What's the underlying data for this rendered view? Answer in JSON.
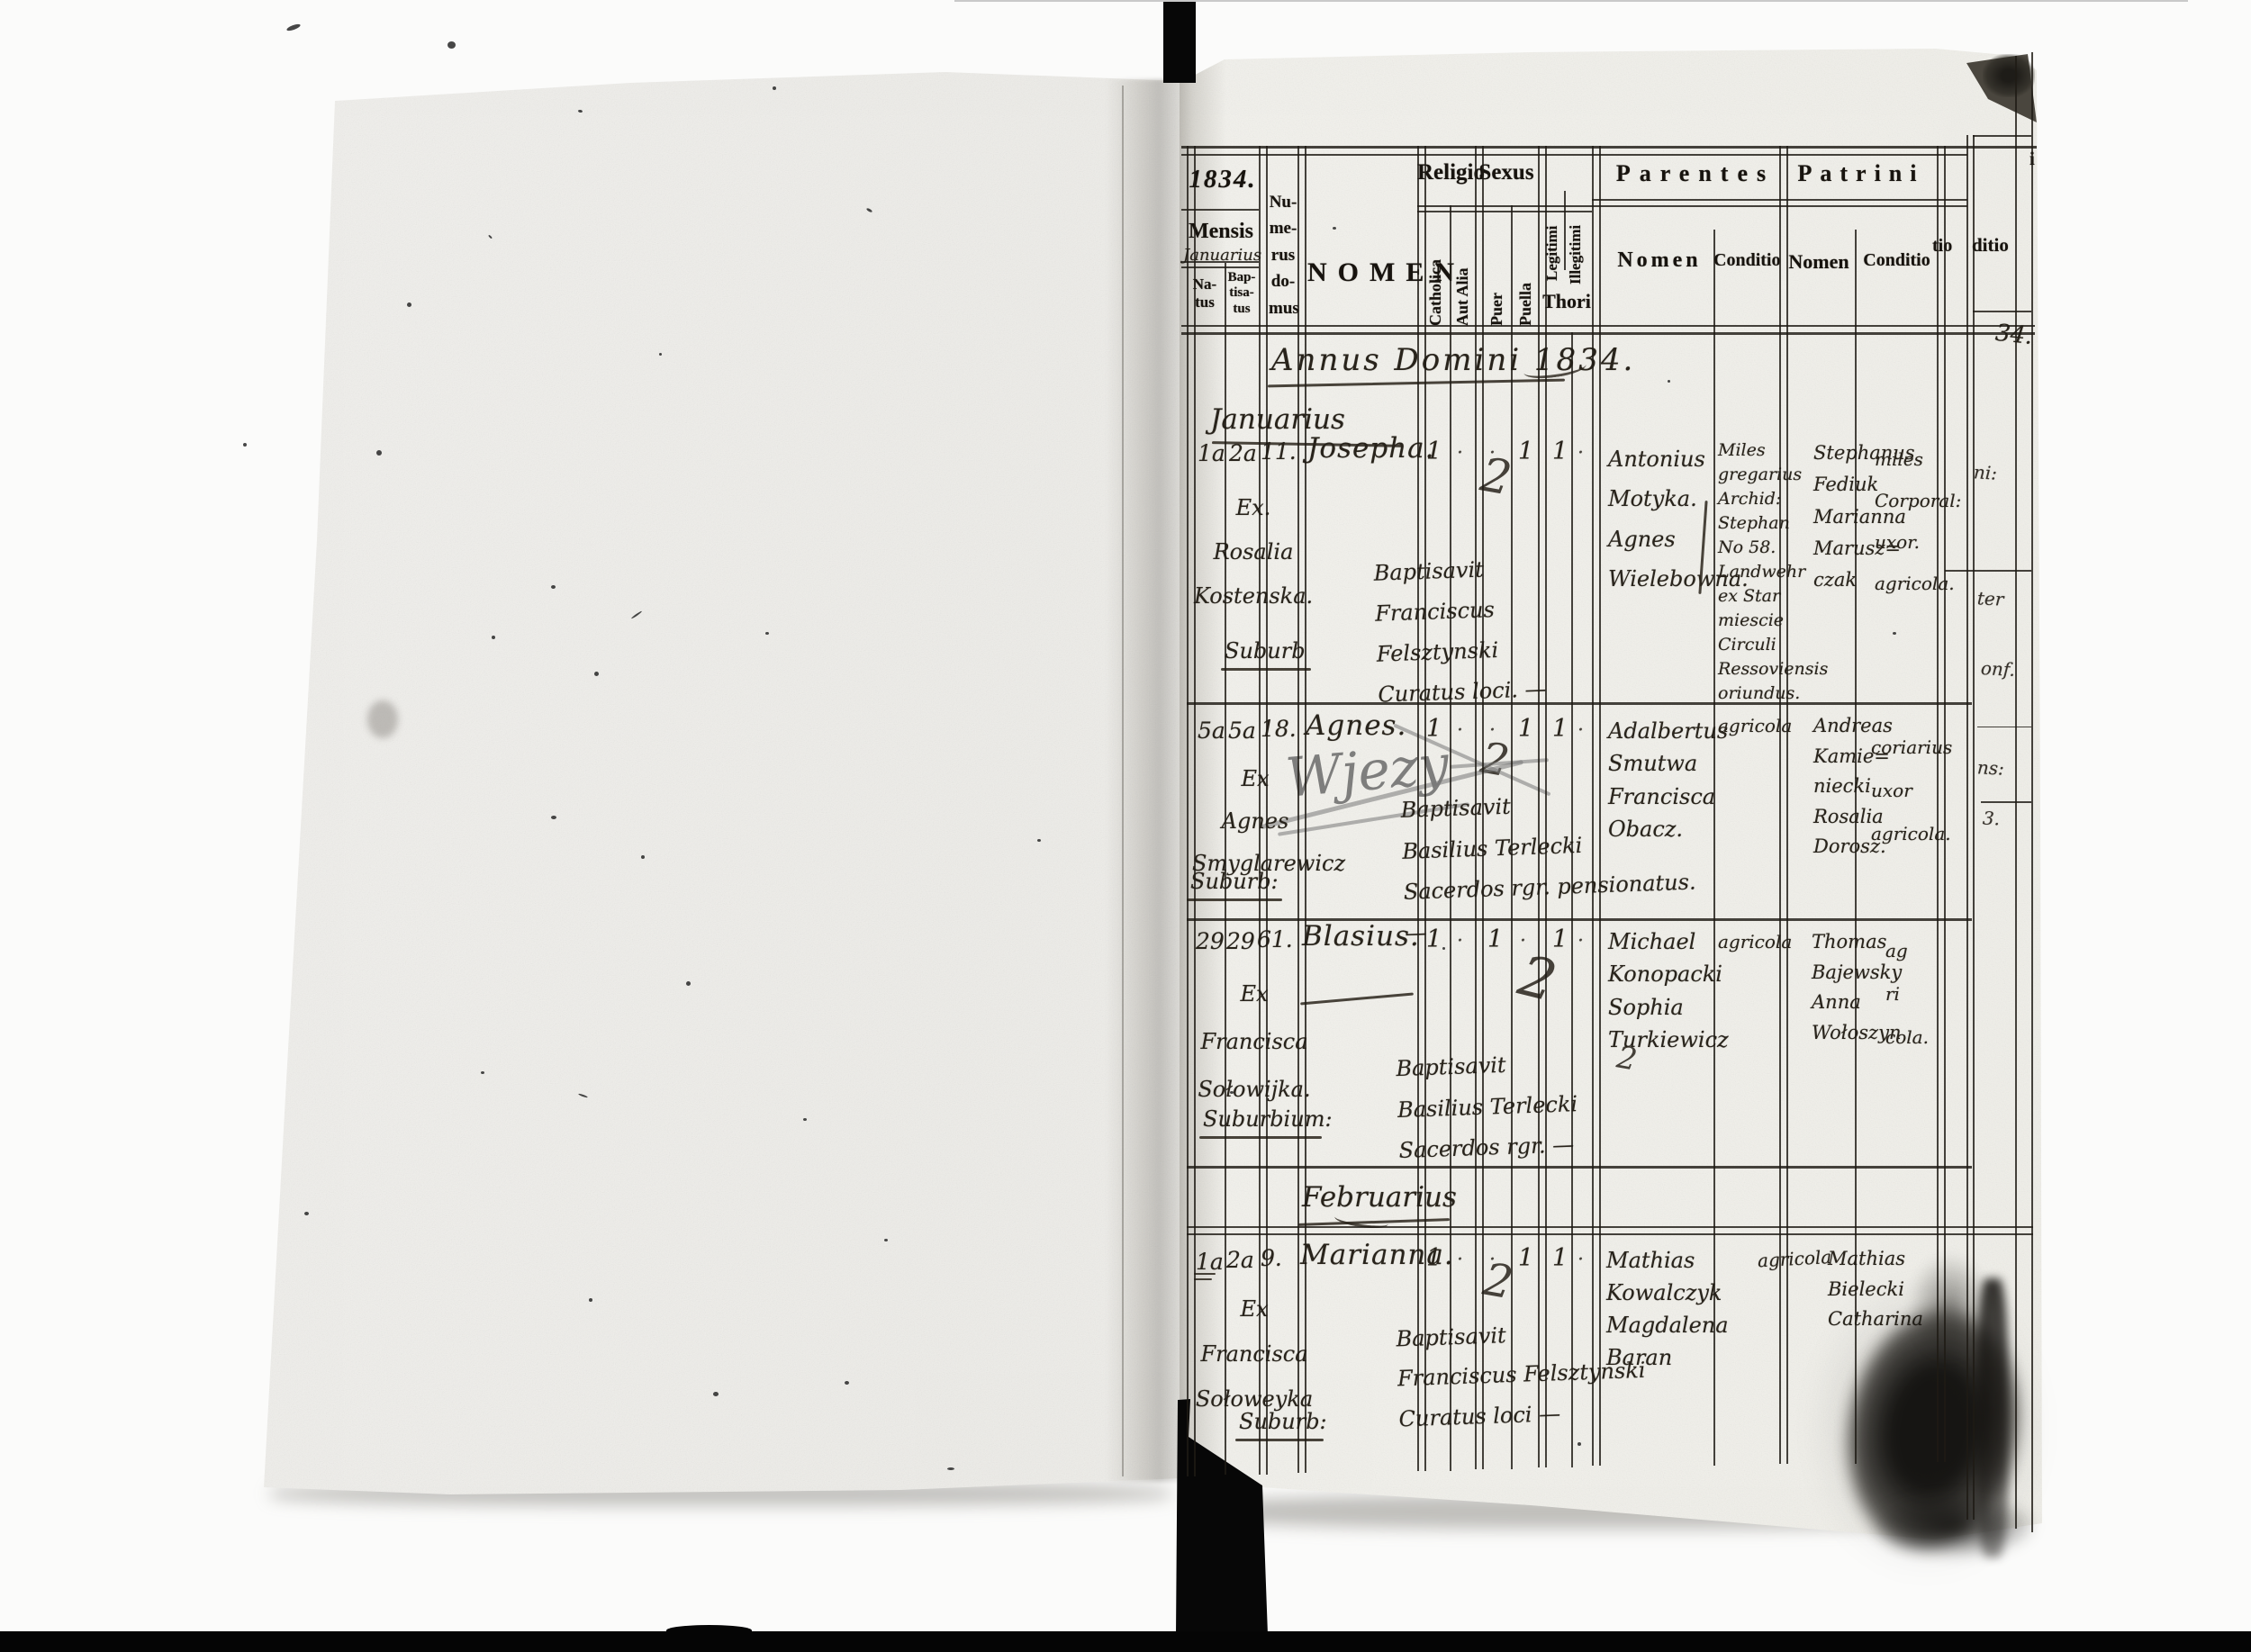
{
  "document": {
    "annus_line": "Annus Domini 1834.",
    "months": {
      "january": "Januarius",
      "february": "Februarius"
    }
  },
  "header": {
    "year_box": "1834.",
    "mensis_label": "Mensis",
    "mensis_value": "Januarius",
    "natus": "Na-\ntus",
    "baptisatus": "Bap-\ntisa-\ntus",
    "numerus_domus": "Nu-\nme-\nrus\ndo-\nmus",
    "nomen": "NOMEN",
    "religio": "Religio",
    "catholica": "Catholica",
    "aut_alia": "Aut Alia",
    "sexus": "Sexus",
    "puer": "Puer",
    "puella": "Puella",
    "legitimi": "Legitimi",
    "illegitimi": "Illegitimi",
    "thori": "Thori",
    "parentes": "Parentes",
    "parentes_nomen": "Nomen",
    "parentes_conditio": "Conditio",
    "patrini": "Patrini",
    "patrini_nomen": "Nomen",
    "patrini_conditio": "Conditio",
    "edge_fragment_i": "i",
    "edge_fragment_tio": "tio",
    "edge_fragment_ditio": "ditio",
    "edge_fragment_year": "34."
  },
  "ditto_mark": "2",
  "strip_fragments": [
    "ni:",
    "ter",
    "onf.",
    "ns:",
    "3."
  ],
  "entries": [
    {
      "natus": "1a",
      "baptisatus": "2a",
      "domus": "11.",
      "name": "Josepha.",
      "marks": {
        "catholica": "1",
        "aut_alia": "·",
        "puer": "·",
        "puella": "1",
        "legitimi": "1",
        "illegitimi": "·"
      },
      "ex_note": "Ex.\nRosalia\nKostenska.",
      "locus": "Suburb",
      "baptism_note": "Baptisavit\nFranciscus Felsztynski\nCuratus loci. —",
      "parentes_nomen": "Antonius\nMotyka.\nAgnes\nWielebowna.",
      "parentes_conditio": "Miles\ngregarius\nArchid:\nStephan\nNo 58.\nLandwehr\nex Star\nmiescie\nCirculi\nRessoviensis\noriundus.",
      "patrini_nomen": "Stephanus\nFediuk\nMarianna\nMarusz=\nczak",
      "patrini_conditio": "miles\nCorporal:\nuxor.\nagricola."
    },
    {
      "natus": "5a",
      "baptisatus": "5a",
      "domus": "18.",
      "name": "Agnes.",
      "marks": {
        "catholica": "1",
        "aut_alia": "·",
        "puer": "·",
        "puella": "1",
        "legitimi": "1",
        "illegitimi": "·"
      },
      "pencil_note": "Wjezy",
      "ex_note": "Ex\nAgnes\nSmyglarewicz",
      "locus": "Suburb:",
      "baptism_note": "Baptisavit\nBasilius Terlecki\nSacerdos rgr. pensionatus. —",
      "parentes_nomen": "Adalbertus\nSmutwa\nFrancisca\nObacz.",
      "parentes_conditio": "agricola",
      "patrini_nomen": "Andreas\nKamie=\nniecki\nRosalia\nDorosz.",
      "patrini_conditio": "coriarius\nuxor\nagricola."
    },
    {
      "natus": "29",
      "baptisatus": "29",
      "domus": "61.",
      "name": "Blasius.",
      "marks": {
        "catholica": "1",
        "aut_alia": "·",
        "puer": "1",
        "puella": "·",
        "legitimi": "1",
        "illegitimi": "·"
      },
      "ex_note": "Ex\nFrancisca\nSołowijka.",
      "locus": "Suburbium:",
      "baptism_note": "Baptisavit\nBasilius Terlecki\nSacerdos rgr. —",
      "parentes_nomen": "Michael\nKonopacki\nSophia\nTurkiewicz",
      "parentes_conditio": "agricola",
      "patrini_nomen": "Thomas\nBajewsky\nAnna\nWołoszyn",
      "patrini_conditio": "ag\nri\ncola."
    },
    {
      "natus": "1a",
      "baptisatus": "2a",
      "domus": "9.",
      "name": "Marianna.",
      "marks": {
        "catholica": "1",
        "aut_alia": "·",
        "puer": "·",
        "puella": "1",
        "legitimi": "1",
        "illegitimi": "·"
      },
      "ex_note": "Ex\nFrancisca\nSołoweyka",
      "locus": "Suburb:",
      "baptism_note": "Baptisavit\nFranciscus Felsztynski\nCuratus loci —",
      "parentes_nomen": "Mathias\nKowalczyk\nMagdalena\nBaran",
      "parentes_conditio": "agricola",
      "patrini_nomen": "Mathias\nBielecki\nCatharina",
      "patrini_conditio": ""
    }
  ]
}
